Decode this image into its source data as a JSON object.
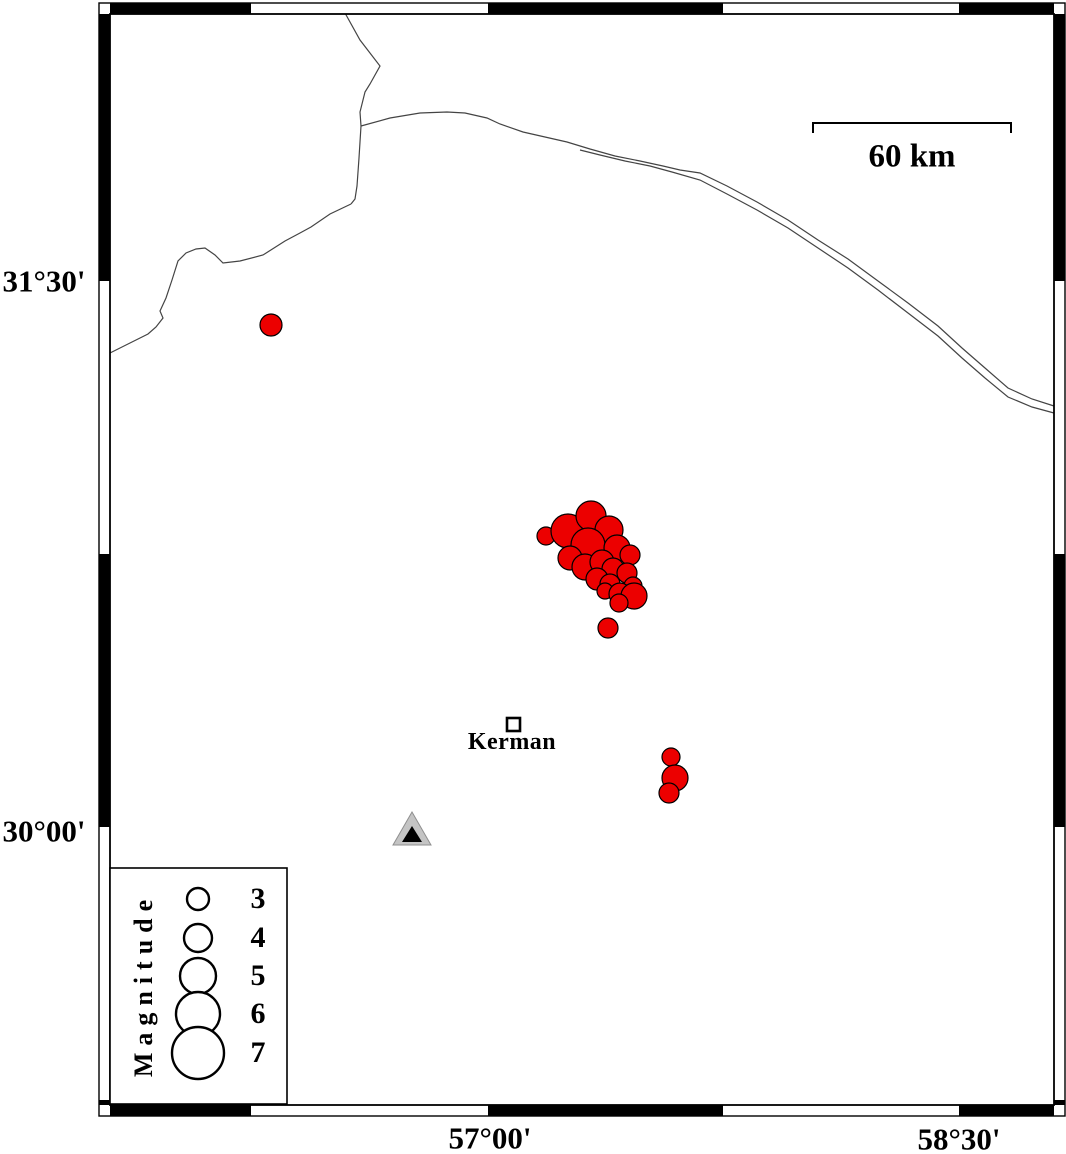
{
  "figure": {
    "width": 1066,
    "height": 1154,
    "background": "#ffffff"
  },
  "colors": {
    "earthquake_fill": "#ec0000",
    "outline": "#000000",
    "line": "#444444",
    "station_fill": "#c4c4c4",
    "station_edge": "#8f8f8f"
  },
  "axis": {
    "left_labels": [
      {
        "text": "31°30'",
        "x": 44,
        "y": 281
      },
      {
        "text": "30°00'",
        "x": 44,
        "y": 831
      }
    ],
    "bottom_labels": [
      {
        "text": "57°00'",
        "x": 490,
        "y": 1138
      },
      {
        "text": "58°30'",
        "x": 959,
        "y": 1139
      }
    ]
  },
  "scalebar": {
    "label": "60 km",
    "x1": 813,
    "x2": 1011,
    "y": 123,
    "tick": 10,
    "label_x": 912,
    "label_y": 157
  },
  "city": {
    "label": "Kerman",
    "x": 507,
    "y": 718,
    "size": 13,
    "label_x": 512,
    "label_y": 742
  },
  "legend": {
    "title": "Magnitude",
    "title_x": 144,
    "title_y": 985,
    "box": {
      "x": 110,
      "y": 868,
      "w": 177,
      "h": 236
    },
    "circle_cx": 198,
    "label_x": 258,
    "items": [
      {
        "label": "3",
        "cy": 899,
        "r": 11
      },
      {
        "label": "4",
        "cy": 938,
        "r": 14
      },
      {
        "label": "5",
        "cy": 976,
        "r": 18
      },
      {
        "label": "6",
        "cy": 1014,
        "r": 22
      },
      {
        "label": "7",
        "cy": 1053,
        "r": 26
      }
    ]
  },
  "map": {
    "frame": {
      "outer": [
        99,
        3,
        966,
        1113
      ],
      "inner": [
        110,
        14,
        944,
        1091
      ],
      "band": 11,
      "top_black": [
        [
          110,
          251
        ],
        [
          488,
          723
        ],
        [
          959,
          1054
        ]
      ],
      "side_black": [
        [
          14,
          281
        ],
        [
          554,
          827
        ],
        [
          1100,
          1105
        ]
      ]
    },
    "lines": [
      {
        "name": "road-north",
        "points": [
          [
            345,
            13
          ],
          [
            360,
            40
          ],
          [
            380,
            66
          ],
          [
            370,
            84
          ],
          [
            365,
            92
          ],
          [
            360,
            112
          ],
          [
            361,
            126
          ],
          [
            359,
            158
          ],
          [
            357,
            186
          ],
          [
            355,
            199
          ],
          [
            351,
            204
          ]
        ]
      },
      {
        "name": "road-west",
        "points": [
          [
            351,
            204
          ],
          [
            330,
            214
          ],
          [
            311,
            227
          ],
          [
            300,
            233
          ],
          [
            285,
            241
          ],
          [
            263,
            255
          ],
          [
            240,
            261
          ],
          [
            223,
            263
          ],
          [
            215,
            255
          ],
          [
            205,
            248
          ],
          [
            196,
            249
          ],
          [
            186,
            253
          ],
          [
            178,
            261
          ],
          [
            172,
            280
          ],
          [
            166,
            298
          ],
          [
            160,
            311
          ],
          [
            163,
            318
          ],
          [
            156,
            327
          ],
          [
            148,
            334
          ],
          [
            128,
            344
          ],
          [
            110,
            353
          ]
        ]
      },
      {
        "name": "road-east-upper",
        "points": [
          [
            361,
            126
          ],
          [
            390,
            118
          ],
          [
            420,
            113
          ],
          [
            447,
            112
          ],
          [
            465,
            113
          ],
          [
            487,
            118
          ],
          [
            500,
            124
          ],
          [
            523,
            132
          ],
          [
            545,
            137
          ],
          [
            567,
            142
          ],
          [
            590,
            149
          ],
          [
            615,
            156
          ],
          [
            640,
            161
          ],
          [
            663,
            166
          ],
          [
            680,
            170
          ],
          [
            700,
            173
          ],
          [
            727,
            186
          ],
          [
            757,
            202
          ],
          [
            788,
            220
          ],
          [
            818,
            240
          ],
          [
            848,
            259
          ],
          [
            878,
            281
          ],
          [
            908,
            303
          ],
          [
            938,
            326
          ],
          [
            962,
            348
          ],
          [
            985,
            368
          ],
          [
            1008,
            388
          ],
          [
            1032,
            399
          ],
          [
            1054,
            406
          ]
        ]
      },
      {
        "name": "road-east-lower",
        "points": [
          [
            580,
            150
          ],
          [
            600,
            155
          ],
          [
            625,
            161
          ],
          [
            650,
            166
          ],
          [
            672,
            172
          ],
          [
            700,
            180
          ],
          [
            727,
            194
          ],
          [
            757,
            210
          ],
          [
            788,
            228
          ],
          [
            818,
            248
          ],
          [
            848,
            268
          ],
          [
            878,
            290
          ],
          [
            908,
            313
          ],
          [
            938,
            336
          ],
          [
            962,
            358
          ],
          [
            985,
            378
          ],
          [
            1008,
            397
          ],
          [
            1032,
            407
          ],
          [
            1054,
            413
          ]
        ]
      }
    ],
    "earthquakes": [
      {
        "x": 271,
        "y": 325,
        "r": 11
      },
      {
        "x": 546,
        "y": 536,
        "r": 9
      },
      {
        "x": 568,
        "y": 531,
        "r": 17
      },
      {
        "x": 591,
        "y": 516,
        "r": 15
      },
      {
        "x": 609,
        "y": 530,
        "r": 14
      },
      {
        "x": 588,
        "y": 545,
        "r": 17
      },
      {
        "x": 617,
        "y": 548,
        "r": 13
      },
      {
        "x": 630,
        "y": 555,
        "r": 10
      },
      {
        "x": 570,
        "y": 558,
        "r": 12
      },
      {
        "x": 585,
        "y": 567,
        "r": 13
      },
      {
        "x": 602,
        "y": 562,
        "r": 12
      },
      {
        "x": 613,
        "y": 569,
        "r": 11
      },
      {
        "x": 627,
        "y": 573,
        "r": 10
      },
      {
        "x": 597,
        "y": 579,
        "r": 11
      },
      {
        "x": 610,
        "y": 584,
        "r": 10
      },
      {
        "x": 633,
        "y": 586,
        "r": 9
      },
      {
        "x": 605,
        "y": 591,
        "r": 8
      },
      {
        "x": 620,
        "y": 594,
        "r": 11
      },
      {
        "x": 634,
        "y": 596,
        "r": 13
      },
      {
        "x": 619,
        "y": 603,
        "r": 9
      },
      {
        "x": 608,
        "y": 628,
        "r": 10
      },
      {
        "x": 671,
        "y": 757,
        "r": 9
      },
      {
        "x": 675,
        "y": 778,
        "r": 13
      },
      {
        "x": 669,
        "y": 793,
        "r": 10
      }
    ],
    "station": {
      "outer": [
        [
          412,
          812
        ],
        [
          393,
          845
        ],
        [
          431,
          845
        ]
      ],
      "inner": [
        [
          412,
          826
        ],
        [
          402,
          842
        ],
        [
          422,
          842
        ]
      ]
    }
  }
}
